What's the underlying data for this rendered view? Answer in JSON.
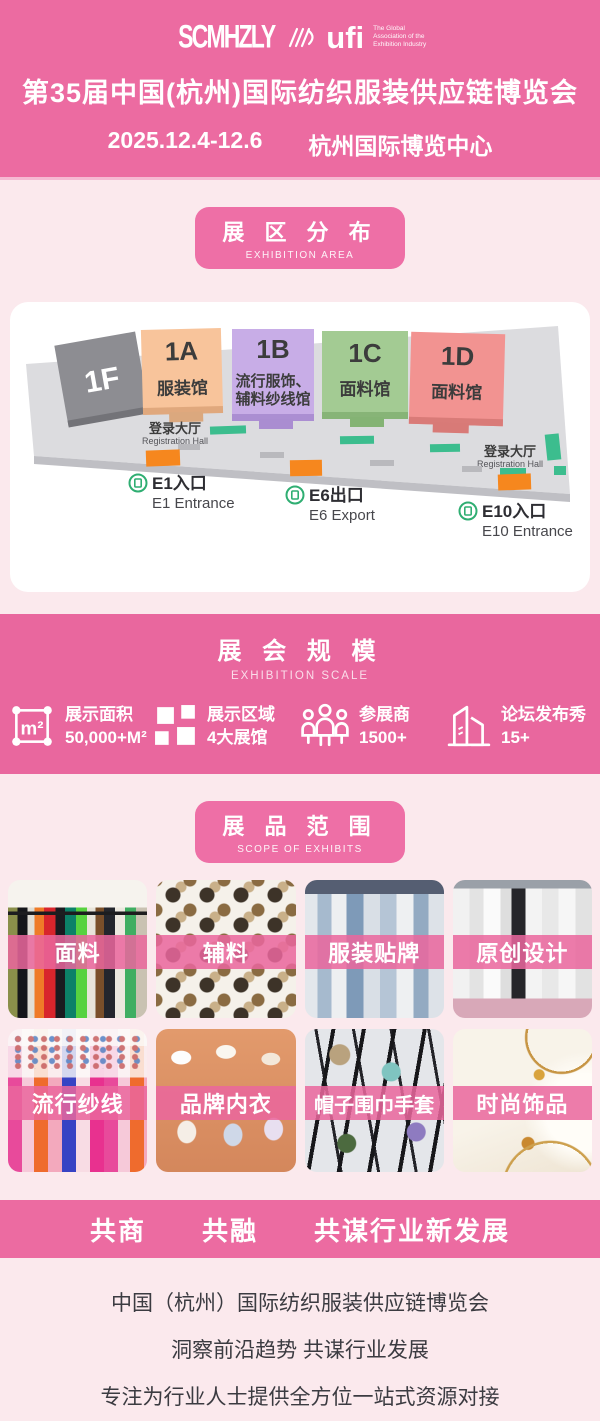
{
  "colors": {
    "header_pink": "#EC6BA1",
    "body_pink": "#FBE9ED",
    "badge_pink": "#EE6FA6",
    "band_pink": "#E9679E",
    "tile_label_pink": "#EA67A0",
    "accent_orange": "#F6871E",
    "accent_green": "#3CBD8E",
    "hall_1f": "#8D8D92",
    "hall_1a": "#F8C49B",
    "hall_1b": "#C8ADE7",
    "hall_1c": "#A3CB93",
    "hall_1d": "#F29391"
  },
  "header": {
    "logo_scm": "SCMHZLY",
    "logo_ufi": "ufi",
    "ufi_tagline": [
      "The Global",
      "Association of the",
      "Exhibition Industry"
    ],
    "title": "第35届中国(杭州)国际纺织服装供应链博览会",
    "date": "2025.12.4-12.6",
    "venue": "杭州国际博览中心"
  },
  "area_section": {
    "title_cn": "展 区 分 布",
    "title_en": "EXHIBITION AREA"
  },
  "map": {
    "halls": [
      {
        "id": "1F",
        "name": ""
      },
      {
        "id": "1A",
        "name": "服装馆"
      },
      {
        "id": "1B",
        "name": "流行服饰、",
        "name2": "辅料纱线馆"
      },
      {
        "id": "1C",
        "name": "面料馆"
      },
      {
        "id": "1D",
        "name": "面料馆"
      }
    ],
    "registration_left_cn": "登录大厅",
    "registration_left_en": "Registration Hall",
    "registration_right_cn": "登录大厅",
    "registration_right_en": "Registration Hall",
    "entrances": [
      {
        "cn": "E1入口",
        "en": "E1 Entrance"
      },
      {
        "cn": "E6出口",
        "en": "E6 Export"
      },
      {
        "cn": "E10入口",
        "en": "E10 Entrance"
      }
    ]
  },
  "scale_section": {
    "title_cn": "展 会 规 模",
    "title_en": "EXHIBITION SCALE",
    "stats": [
      {
        "icon": "area-measure-icon",
        "label": "展示面积",
        "value": "50,000+M²"
      },
      {
        "icon": "exhibition-halls-icon",
        "label": "展示区域",
        "value": "4大展馆"
      },
      {
        "icon": "exhibitors-icon",
        "label": "参展商",
        "value": "1500+"
      },
      {
        "icon": "forum-shows-icon",
        "label": "论坛发布秀",
        "value": "15+"
      }
    ]
  },
  "exhibits_section": {
    "title_cn": "展 品 范 围",
    "title_en": "SCOPE OF EXHIBITS",
    "items": [
      {
        "label": "面料"
      },
      {
        "label": "辅料"
      },
      {
        "label": "服装贴牌"
      },
      {
        "label": "原创设计"
      },
      {
        "label": "流行纱线"
      },
      {
        "label": "品牌内衣"
      },
      {
        "label": "帽子围巾手套"
      },
      {
        "label": "时尚饰品"
      }
    ]
  },
  "footer": {
    "banner": "共商　　共融　　共谋行业新发展",
    "lines": [
      "中国（杭州）国际纺织服装供应链博览会",
      "洞察前沿趋势 共谋行业发展",
      "专注为行业人士提供全方位一站式资源对接"
    ]
  }
}
